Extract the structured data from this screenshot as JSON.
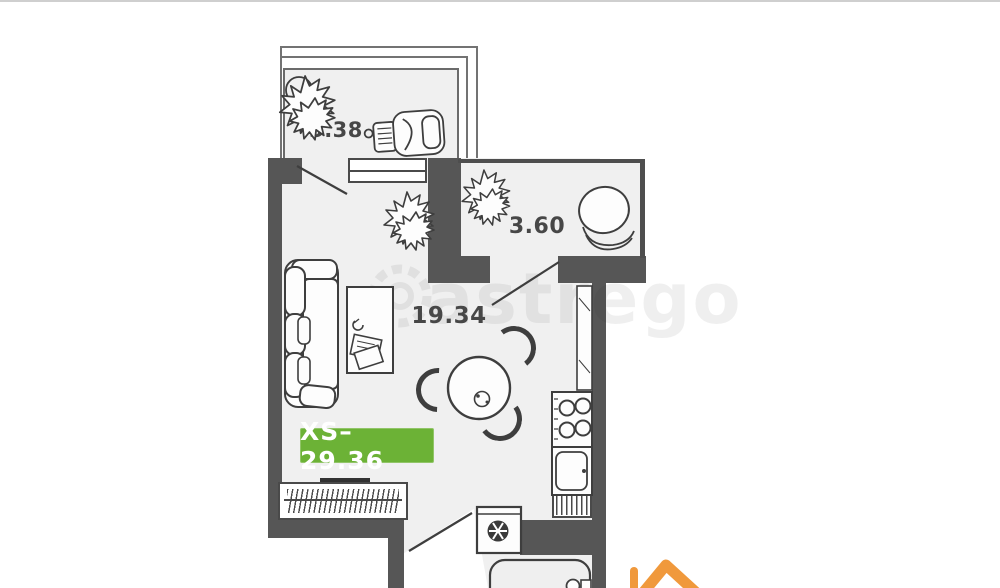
{
  "watermark": {
    "text": "astrego"
  },
  "badge": {
    "label": "XS–29.36",
    "background": "#6cb236",
    "text_color": "#ffffff"
  },
  "rooms": {
    "living_room": {
      "area_label": "19.34"
    },
    "bathroom": {
      "area_label": "3.60"
    },
    "balcony": {
      "area_label": "3.38"
    }
  },
  "colors": {
    "wall": "#565656",
    "floor": "#f0f0f0",
    "furniture_line": "#3e3e3e",
    "badge_green": "#6cb236",
    "logo_orange": "#f0993c",
    "background": "#ffffff"
  },
  "icons": {
    "watermark_gear": "gear-icon",
    "brand": "house-logo-icon"
  }
}
